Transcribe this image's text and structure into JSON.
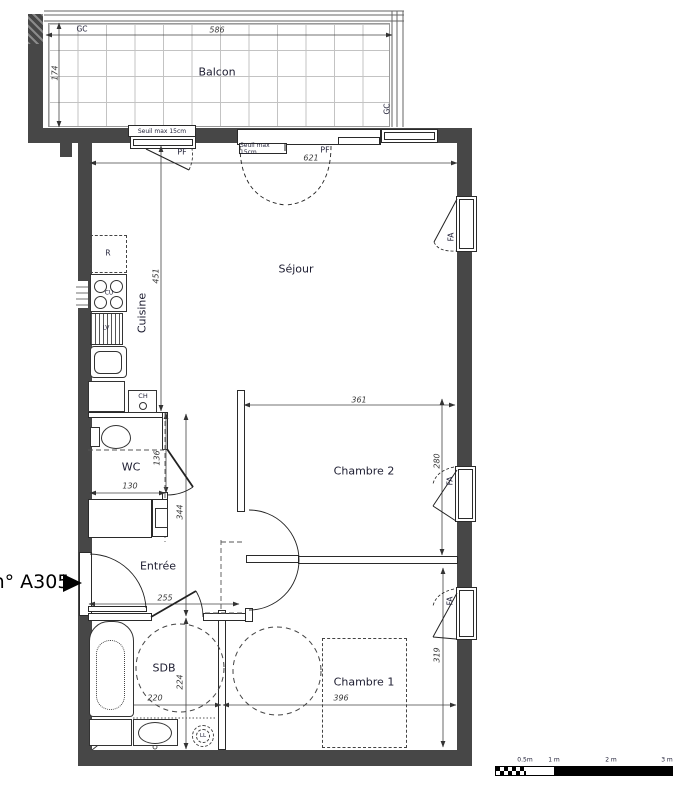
{
  "unit_label": "n° A305",
  "rooms": {
    "balcony": "Balcon",
    "living": "Séjour",
    "kitchen": "Cuisine",
    "wc": "WC",
    "entry": "Entrée",
    "bathroom": "SDB",
    "bedroom1": "Chambre 1",
    "bedroom2": "Chambre 2"
  },
  "tags": {
    "gc": "GC",
    "pf": "PF",
    "fa": "FA",
    "fridge": "R",
    "cooktop": "CU",
    "dishwasher": "LV",
    "boiler": "CH",
    "washer": "LL",
    "sill": "Seuil max 15cm"
  },
  "dimensions": {
    "balcony_width": "586",
    "balcony_depth": "174",
    "living_width": "621",
    "kitchen_depth": "451",
    "bedroom2_width": "361",
    "bedroom2_depth": "280",
    "hall_length": "344",
    "wc_depth": "136",
    "wc_width": "130",
    "entry_width": "255",
    "bathroom_depth": "224",
    "bathroom_width": "220",
    "bedroom1_width": "396",
    "bedroom1_depth": "319"
  },
  "scale_bar": {
    "labels": [
      "0.5m",
      "1 m",
      "2 m",
      "3 m"
    ]
  }
}
